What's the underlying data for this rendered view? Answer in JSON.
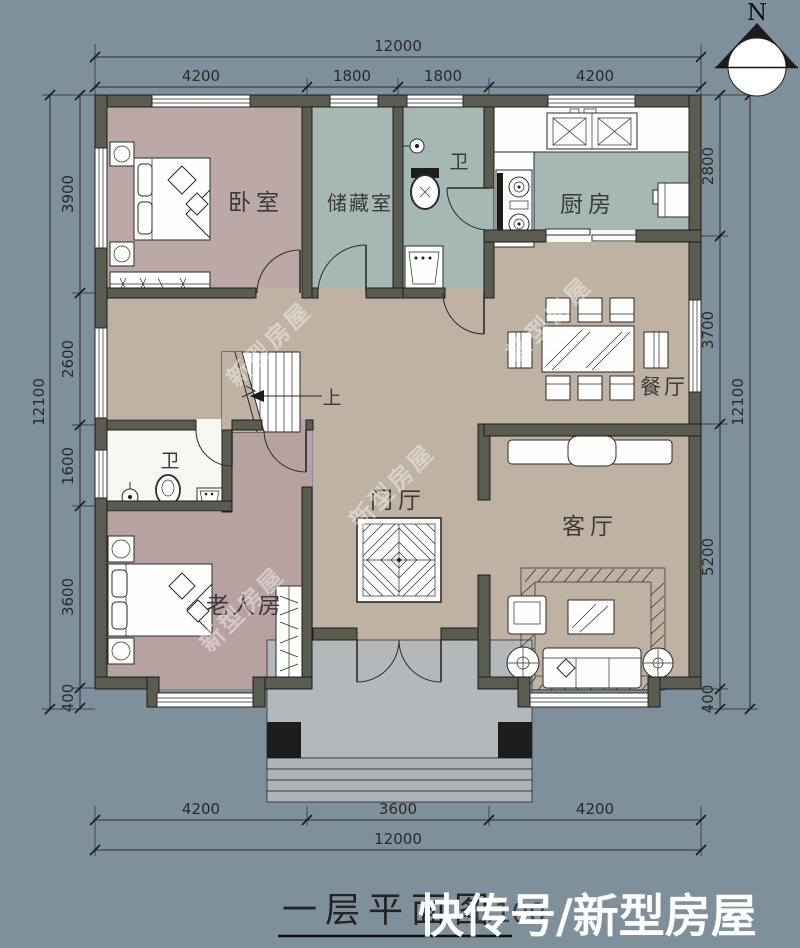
{
  "compass": {
    "label": "N"
  },
  "rooms": {
    "bedroom": "卧室",
    "storage": "储藏室",
    "bathroom_top": "卫",
    "kitchen": "厨房",
    "dining": "餐厅",
    "bathroom_left": "卫",
    "foyer": "门厅",
    "elderly_room": "老人房",
    "living": "客厅",
    "stairs_up": "上"
  },
  "dimensions": {
    "top": {
      "overall": "12000",
      "segments": [
        "4200",
        "1800",
        "1800",
        "4200"
      ]
    },
    "bottom": {
      "overall": "12000",
      "segments": [
        "4200",
        "3600",
        "4200"
      ]
    },
    "left": {
      "overall": "12100",
      "segments": [
        "3900",
        "2600",
        "1600",
        "3600",
        "400"
      ]
    },
    "right": {
      "overall": "12100",
      "segments": [
        "2800",
        "3700",
        "5200",
        "400"
      ]
    }
  },
  "title": {
    "text": "一层平面图",
    "scale": "1:100"
  },
  "watermarks": {
    "bottom": "快传号/新型房屋",
    "diagonal": "新型房屋"
  },
  "colors": {
    "background": "#7E909B",
    "wall": "#5A5C4F",
    "bedroom_floor": "#BDA8A8",
    "utility_floor": "#A5B8B4",
    "hall_floor": "#BFB2A2",
    "vestibule_floor": "#B7A1A1",
    "porch": "#B4B8BB",
    "line": "#2B2B2B",
    "watermark": "#FFFFFF"
  }
}
